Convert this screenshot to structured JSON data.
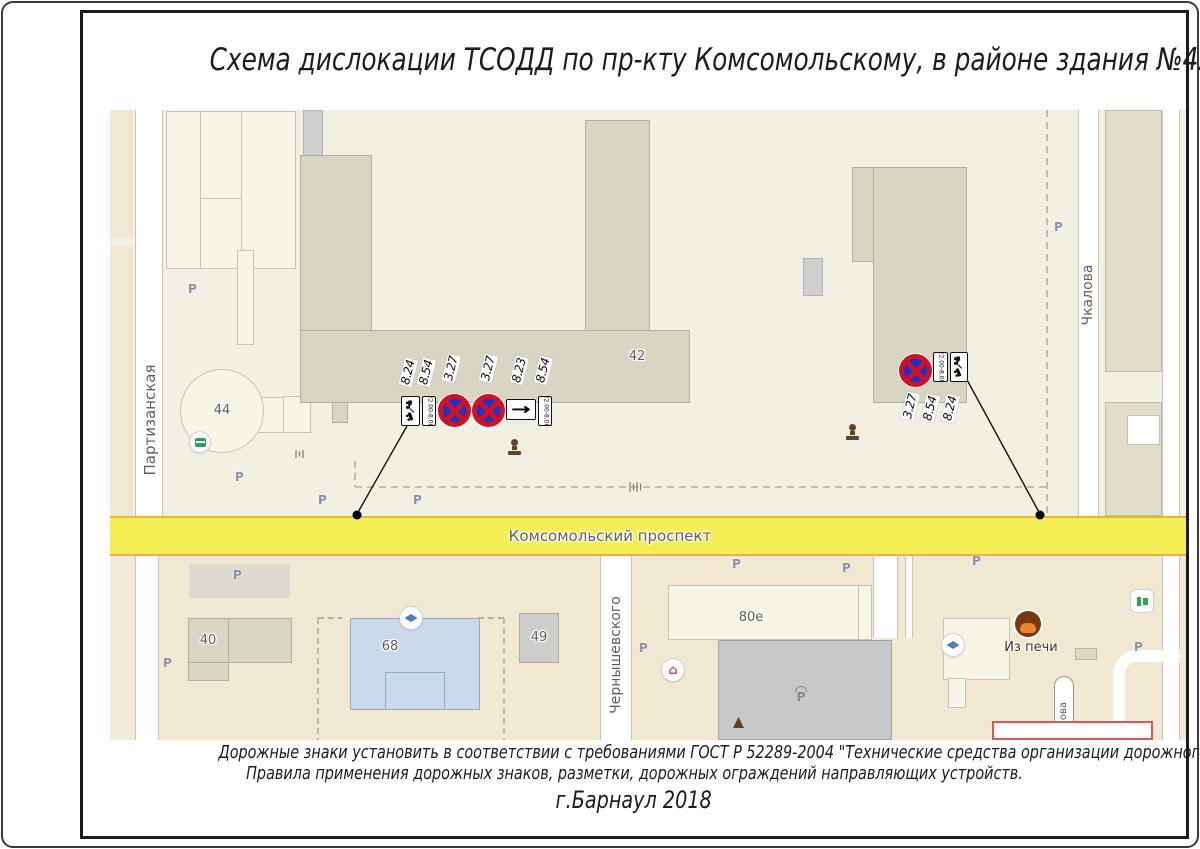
{
  "title": "Схема дислокации ТСОДД по пр-кту Комсомольскому, в районе здания №42",
  "footer": {
    "line1": "Дорожные знаки установить в соответствии с требованиями ГОСТ Р 52289-2004 \"Технические средства организации дорожного движения.",
    "line2": "Правила применения дорожных знаков, разметки, дорожных  ограждений направляющих устройств.",
    "line3": "г.Барнаул 2018"
  },
  "map": {
    "streets": {
      "left": "Партизанская",
      "main": "Комсомольский проспект",
      "bottom_left": "Чернышевского",
      "right": "Чкалова",
      "dead_end_partial": "ова"
    },
    "buildings": {
      "b44": "44",
      "b42": "42",
      "b40": "40",
      "b68": "68",
      "b49": "49",
      "b80e": "80е"
    },
    "poi": {
      "bakery": "Из печи"
    },
    "parking_label": "P",
    "covered_parking_label": "P"
  },
  "signs": {
    "left_cluster": {
      "labels": [
        "8.24",
        "8.54",
        "3.27",
        "3.27",
        "8.23",
        "8.54"
      ]
    },
    "right_cluster": {
      "labels": [
        "3.27",
        "8.54",
        "8.24"
      ]
    },
    "time_plate_text": "22.00-8.00",
    "arrow_glyph": "→"
  },
  "colors": {
    "map_upper_bg": "#F2F0E2",
    "map_lower_bg": "#F1E8D1",
    "block_fill": "#F7F5E6",
    "block_outline": "#C8C4B4",
    "building_fill": "#D9D5C3",
    "building_outline": "#B3AFA0",
    "road_yellow": "#F3EF55",
    "road_border": "#E9B04A",
    "street_casing": "#C9C5B8",
    "school_fill": "#CBD9EC",
    "school_outline": "#93ACC9",
    "sign_blue": "#1733C9",
    "sign_red": "#CE1126",
    "label_gray": "#60605A",
    "parking_blue": "#8593A9",
    "monument_brown": "#5E4428",
    "bakery_brown": "#76380E",
    "bakery_bun": "#E8872B"
  }
}
